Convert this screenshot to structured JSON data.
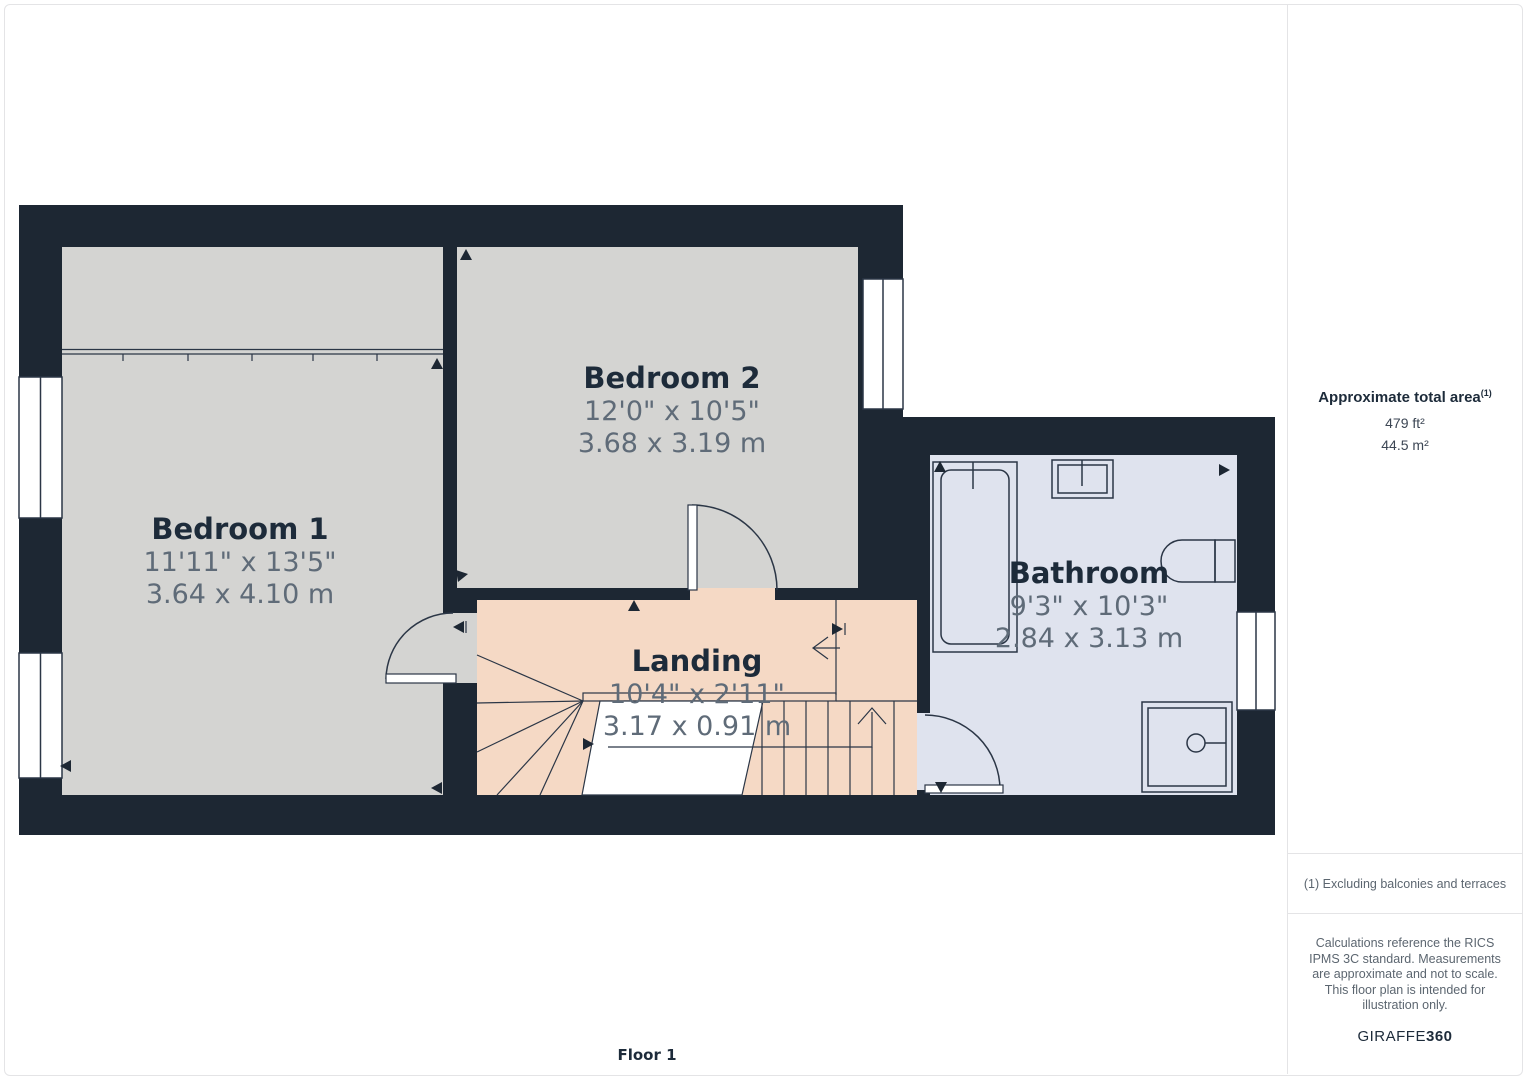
{
  "floorplan": {
    "floor_label": "Floor 1",
    "rooms": [
      {
        "name": "Bedroom 1",
        "size_imperial": "11'11\" x 13'5\"",
        "size_metric": "3.64 x 4.10 m"
      },
      {
        "name": "Bedroom 2",
        "size_imperial": "12'0\" x 10'5\"",
        "size_metric": "3.68 x 3.19 m"
      },
      {
        "name": "Landing",
        "size_imperial": "10'4\" x 2'11\"",
        "size_metric": "3.17 x 0.91 m"
      },
      {
        "name": "Bathroom",
        "size_imperial": "9'3\" x 10'3\"",
        "size_metric": "2.84 x 3.13 m"
      }
    ],
    "colors": {
      "wall": "#1d2733",
      "room-gray": "#d4d4d2",
      "landing-peach": "#f5d9c5",
      "bathroom-blue": "#dfe3ee",
      "line": "#2b3646",
      "border": "#e4e4e6",
      "text-dark": "#1d2b3a",
      "text-gray": "#5f6b78"
    }
  },
  "sidebar": {
    "total_area_label": "Approximate total area",
    "total_area_superscript": "(1)",
    "area_imperial": "479 ft²",
    "area_metric": "44.5 m²",
    "footnote": "(1) Excluding balconies and terraces",
    "disclaimer": "Calculations reference the RICS IPMS 3C standard. Measurements are approximate and not to scale. This floor plan is intended for illustration only.",
    "brand_name": "GIRAFFE",
    "brand_bold": "360"
  }
}
